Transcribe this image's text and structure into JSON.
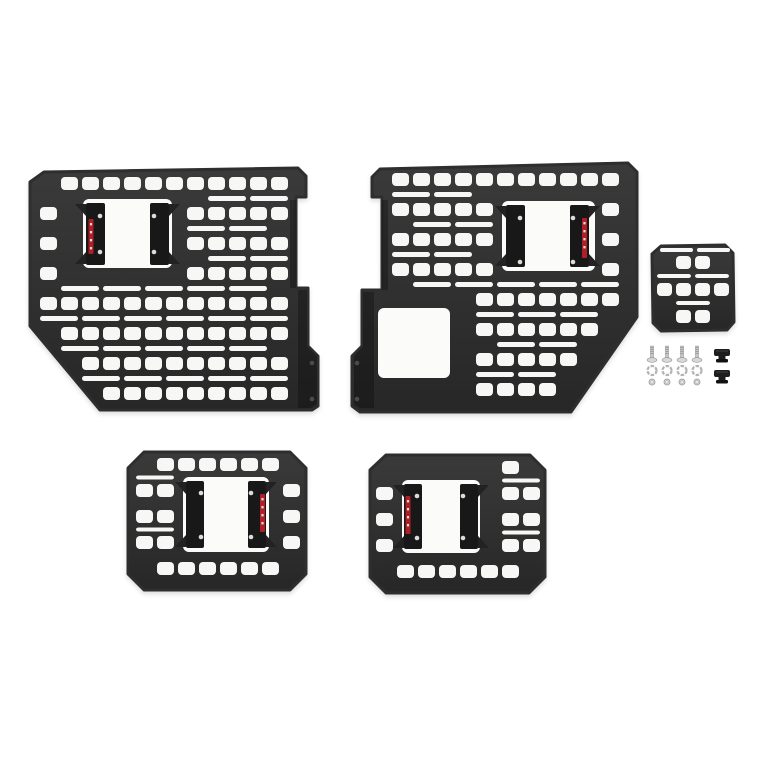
{
  "scene": {
    "description": "Product photo of a modular truck-bed MOLLE rack panel kit: two large bedside panels with mounting brackets, two medium panels with brackets, one small accessory panel, and mounting hardware (bolts, lock washers, nuts, bed clamps) on a white background",
    "background_color": "#ffffff"
  },
  "colors": {
    "panel_top": "#3a3a3a",
    "panel_bottom": "#272727",
    "panel_stroke": "#2e2e2e",
    "hole": "#f7f7f5",
    "window": "#fbfbfa",
    "bracket": "#181818",
    "bracket_wing": "#222222",
    "screw_dot": "#dcdcdc",
    "sticker_red": "#b01e28",
    "sticker_mark": "#f2d7d9",
    "flange_shade": "rgba(0,0,0,0.27)",
    "flange_hole": "#4a4a4a",
    "metal": "#c6c6c6",
    "metal_dark": "#8f8f8f",
    "metal_light": "#d8d8d8",
    "clamp": "#1d1d1d",
    "clamp_dark": "#111111"
  },
  "panels": [
    {
      "name": "molle-panel-large-driver-side",
      "outline": [
        [
          44,
          172
        ],
        [
          298,
          168
        ],
        [
          306,
          176
        ],
        [
          306,
          197
        ],
        [
          296,
          197
        ],
        [
          296,
          288
        ],
        [
          308,
          288
        ],
        [
          308,
          346
        ],
        [
          318,
          356
        ],
        [
          318,
          406
        ],
        [
          312,
          410
        ],
        [
          100,
          410
        ],
        [
          30,
          326
        ],
        [
          30,
          182
        ]
      ],
      "grid": {
        "x0": 40,
        "y0": 177,
        "cols": 12,
        "rows": 8,
        "colPitch": 21,
        "rowPitch": 30,
        "sqW": 17,
        "sqH": 13,
        "slotH": 5
      },
      "skips": [
        [
          74,
          190,
          104,
          88
        ]
      ],
      "windows": [
        [
          83,
          199,
          89,
          69
        ]
      ],
      "brackets": [
        {
          "x": 86,
          "y": 203,
          "w": 19,
          "h": 62,
          "wing": "out-left",
          "sticker": [
            88.5,
            219,
            5,
            35
          ],
          "dots": [
            [
              100,
              216
            ],
            [
              100,
              252
            ]
          ]
        },
        {
          "x": 150,
          "y": 203,
          "w": 19,
          "h": 62,
          "wing": "out-right",
          "sticker": null,
          "dots": [
            [
              154,
              216
            ],
            [
              154,
              252
            ]
          ]
        }
      ],
      "flangeShades": [
        [
          [
            290,
            200
          ],
          [
            296,
            200
          ],
          [
            296,
            288
          ],
          [
            290,
            288
          ]
        ],
        [
          [
            298,
            290
          ],
          [
            307,
            290
          ],
          [
            307,
            346
          ],
          [
            317,
            356
          ],
          [
            317,
            404
          ],
          [
            311,
            408
          ],
          [
            298,
            408
          ]
        ]
      ],
      "flangeHoles": [
        [
          312,
          363
        ],
        [
          312,
          399
        ]
      ],
      "extraSlots": []
    },
    {
      "name": "molle-panel-large-passenger-side",
      "outline": [
        [
          380,
          169
        ],
        [
          628,
          163
        ],
        [
          637,
          172
        ],
        [
          637,
          317
        ],
        [
          571,
          412
        ],
        [
          360,
          412
        ],
        [
          352,
          406
        ],
        [
          352,
          356
        ],
        [
          362,
          346
        ],
        [
          362,
          290
        ],
        [
          382,
          290
        ],
        [
          382,
          197
        ],
        [
          372,
          197
        ],
        [
          372,
          177
        ]
      ],
      "grid": {
        "x0": 392,
        "y0": 173,
        "cols": 12,
        "rows": 8,
        "colPitch": 21,
        "rowPitch": 30,
        "sqW": 17,
        "sqH": 13,
        "slotH": 5
      },
      "skips": [
        [
          494,
          192,
          108,
          86
        ],
        [
          370,
          300,
          88,
          86
        ]
      ],
      "windows": [
        [
          502,
          201,
          93,
          70
        ],
        [
          378,
          308,
          72,
          70
        ]
      ],
      "brackets": [
        {
          "x": 506,
          "y": 205,
          "w": 19,
          "h": 62,
          "wing": "out-left",
          "sticker": null,
          "dots": [
            [
              520,
              218
            ],
            [
              520,
              262
            ]
          ]
        },
        {
          "x": 570,
          "y": 205,
          "w": 19,
          "h": 62,
          "wing": "out-right",
          "sticker": [
            582,
            218,
            5,
            40
          ],
          "dots": [
            [
              573,
              218
            ],
            [
              573,
              262
            ]
          ]
        }
      ],
      "flangeShades": [
        [
          [
            382,
            200
          ],
          [
            388,
            200
          ],
          [
            388,
            290
          ],
          [
            382,
            290
          ]
        ],
        [
          [
            374,
            292
          ],
          [
            363,
            292
          ],
          [
            363,
            346
          ],
          [
            354,
            356
          ],
          [
            354,
            404
          ],
          [
            360,
            408
          ],
          [
            374,
            408
          ]
        ]
      ],
      "flangeHoles": [
        [
          357,
          363
        ],
        [
          357,
          399
        ]
      ],
      "extraSlots": []
    },
    {
      "name": "molle-panel-accessory-small",
      "outline": [
        [
          661,
          246
        ],
        [
          725,
          245
        ],
        [
          733,
          253
        ],
        [
          734,
          322
        ],
        [
          727,
          330
        ],
        [
          661,
          331
        ],
        [
          653,
          323
        ],
        [
          652,
          254
        ]
      ],
      "grid": {
        "x0": 657,
        "y0": 256,
        "cols": 4,
        "rows": 3,
        "colPitch": 19,
        "rowPitch": 27,
        "sqW": 15,
        "sqH": 13,
        "slotH": 4
      },
      "skips": [],
      "windows": [],
      "brackets": [],
      "flangeShades": [],
      "flangeHoles": [],
      "extraSlots": [
        [
          660,
          248,
          33,
          4
        ],
        [
          697,
          248,
          33,
          4
        ]
      ]
    },
    {
      "name": "molle-panel-medium-left",
      "outline": [
        [
          144,
          452
        ],
        [
          290,
          452
        ],
        [
          306,
          468
        ],
        [
          306,
          574
        ],
        [
          290,
          590
        ],
        [
          144,
          590
        ],
        [
          128,
          574
        ],
        [
          128,
          468
        ]
      ],
      "grid": {
        "x0": 136,
        "y0": 458,
        "cols": 8,
        "rows": 5,
        "colPitch": 21,
        "rowPitch": 26,
        "sqW": 17,
        "sqH": 13,
        "slotH": 4
      },
      "skips": [
        [
          177,
          471,
          98,
          87
        ]
      ],
      "windows": [
        [
          183,
          477,
          86,
          75
        ]
      ],
      "brackets": [
        {
          "x": 186,
          "y": 481,
          "w": 18,
          "h": 67,
          "wing": "out-left",
          "sticker": null,
          "dots": [
            [
              201,
              493
            ],
            [
              201,
              537
            ]
          ]
        },
        {
          "x": 248,
          "y": 481,
          "w": 18,
          "h": 67,
          "wing": "out-right",
          "sticker": [
            260,
            494,
            5,
            38
          ],
          "dots": [
            [
              251,
              493
            ],
            [
              251,
              537
            ]
          ]
        }
      ],
      "flangeShades": [],
      "flangeHoles": [],
      "extraSlots": []
    },
    {
      "name": "molle-panel-medium-right",
      "outline": [
        [
          386,
          455
        ],
        [
          530,
          455
        ],
        [
          545,
          470
        ],
        [
          545,
          577
        ],
        [
          529,
          593
        ],
        [
          386,
          593
        ],
        [
          370,
          577
        ],
        [
          370,
          470
        ]
      ],
      "grid": {
        "x0": 376,
        "y0": 461,
        "cols": 8,
        "rows": 5,
        "colPitch": 21,
        "rowPitch": 26,
        "sqW": 17,
        "sqH": 13,
        "slotH": 4
      },
      "skips": [
        [
          394,
          473,
          96,
          87
        ]
      ],
      "windows": [
        [
          402,
          480,
          78,
          73
        ]
      ],
      "brackets": [
        {
          "x": 404,
          "y": 484,
          "w": 18,
          "h": 65,
          "wing": "out-left",
          "sticker": [
            405.5,
            496,
            5,
            38
          ],
          "dots": [
            [
              417,
              496
            ],
            [
              417,
              538
            ]
          ]
        },
        {
          "x": 460,
          "y": 484,
          "w": 18,
          "h": 65,
          "wing": "out-right",
          "sticker": null,
          "dots": [
            [
              463,
              496
            ],
            [
              463,
              538
            ]
          ]
        }
      ],
      "flangeShades": [],
      "flangeHoles": [],
      "extraSlots": []
    }
  ],
  "hardware": {
    "name": "mounting-hardware-kit",
    "bolts": {
      "count": 4,
      "xs": [
        652,
        667,
        682,
        697
      ],
      "shaft_top": 346,
      "shaft_h": 12,
      "head_cy": 360
    },
    "washers": {
      "count": 4,
      "xs": [
        652,
        667,
        682,
        697
      ],
      "cy": 370.5,
      "r": 4.5
    },
    "nuts": {
      "count": 4,
      "xs": [
        652,
        667,
        682,
        697
      ],
      "cy": 382,
      "r": 3.1
    },
    "clamps": {
      "count": 2,
      "cx": 722,
      "cys": [
        356,
        377
      ]
    }
  }
}
